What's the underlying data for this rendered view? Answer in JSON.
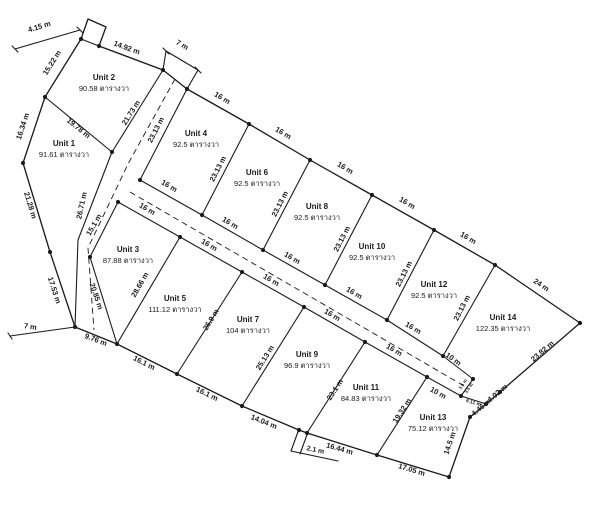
{
  "figure": {
    "kind": "land-subdivision-survey-plan",
    "background": "#ffffff",
    "line_color": "#1a1a1a",
    "text_color": "#1a1a1a",
    "area_unit_label": "ตารางวา"
  },
  "units": [
    {
      "name": "Unit 1",
      "area": "91.61",
      "x": 64,
      "y": 146
    },
    {
      "name": "Unit 2",
      "area": "90.58",
      "x": 104,
      "y": 80
    },
    {
      "name": "Unit 3",
      "area": "87.88",
      "x": 128,
      "y": 252
    },
    {
      "name": "Unit 4",
      "area": "92.5",
      "x": 196,
      "y": 136
    },
    {
      "name": "Unit 5",
      "area": "111.12",
      "x": 175,
      "y": 301
    },
    {
      "name": "Unit 6",
      "area": "92.5",
      "x": 257,
      "y": 175
    },
    {
      "name": "Unit 7",
      "area": "104",
      "x": 248,
      "y": 322
    },
    {
      "name": "Unit 8",
      "area": "92.5",
      "x": 317,
      "y": 209
    },
    {
      "name": "Unit 9",
      "area": "96.9",
      "x": 307,
      "y": 357
    },
    {
      "name": "Unit 10",
      "area": "92.5",
      "x": 372,
      "y": 249
    },
    {
      "name": "Unit 11",
      "area": "84.83",
      "x": 366,
      "y": 390
    },
    {
      "name": "Unit 12",
      "area": "92.5",
      "x": 434,
      "y": 287
    },
    {
      "name": "Unit 13",
      "area": "75.12",
      "x": 433,
      "y": 420
    },
    {
      "name": "Unit 14",
      "area": "122.35",
      "x": 503,
      "y": 320
    }
  ],
  "dimensions": [
    {
      "t": "4.15 m",
      "x": 40,
      "y": 29,
      "r": -17
    },
    {
      "t": "14.92 m",
      "x": 126,
      "y": 50,
      "r": 20
    },
    {
      "t": "7 m",
      "x": 181,
      "y": 47,
      "r": 30
    },
    {
      "t": "15.22 m",
      "x": 54,
      "y": 64,
      "r": -58
    },
    {
      "t": "16.34 m",
      "x": 25,
      "y": 127,
      "r": -72
    },
    {
      "t": "19.78 m",
      "x": 77,
      "y": 130,
      "r": 39
    },
    {
      "t": "21.73 m",
      "x": 133,
      "y": 114,
      "r": -58
    },
    {
      "t": "23.13 m",
      "x": 158,
      "y": 131,
      "r": -63
    },
    {
      "t": "21.28 m",
      "x": 28,
      "y": 206,
      "r": 73
    },
    {
      "t": "26.71 m",
      "x": 84,
      "y": 206,
      "r": -78
    },
    {
      "t": "17.53 m",
      "x": 52,
      "y": 291,
      "r": 72
    },
    {
      "t": "15.1 m",
      "x": 96,
      "y": 226,
      "r": -60
    },
    {
      "t": "20.85 m",
      "x": 94,
      "y": 297,
      "r": 71
    },
    {
      "t": "28.66 m",
      "x": 142,
      "y": 286,
      "r": -60
    },
    {
      "t": "26.9 m",
      "x": 213,
      "y": 321,
      "r": -58
    },
    {
      "t": "25.13 m",
      "x": 267,
      "y": 359,
      "r": -58
    },
    {
      "t": "23.1 m",
      "x": 337,
      "y": 391,
      "r": -57
    },
    {
      "t": "19.32 m",
      "x": 404,
      "y": 412,
      "r": -57
    },
    {
      "t": "9.76 m",
      "x": 95,
      "y": 342,
      "r": 21
    },
    {
      "t": "7 m",
      "x": 30,
      "y": 329,
      "r": 8
    },
    {
      "t": "16.1 m",
      "x": 143,
      "y": 365,
      "r": 27
    },
    {
      "t": "16.1 m",
      "x": 206,
      "y": 396,
      "r": 26
    },
    {
      "t": "14.04 m",
      "x": 263,
      "y": 424,
      "r": 22
    },
    {
      "t": "2.1 m",
      "x": 315,
      "y": 452,
      "r": 12,
      "s": 7
    },
    {
      "t": "16.44 m",
      "x": 339,
      "y": 451,
      "r": 16
    },
    {
      "t": "17.05 m",
      "x": 411,
      "y": 472,
      "r": 17
    },
    {
      "t": "14.5 m",
      "x": 452,
      "y": 444,
      "r": -71
    },
    {
      "t": "4.46 m",
      "x": 483,
      "y": 409,
      "r": -40
    },
    {
      "t": "4.02 m",
      "x": 499,
      "y": 395,
      "r": -40
    },
    {
      "t": "23.82 m",
      "x": 544,
      "y": 353,
      "r": -41
    },
    {
      "t": "24 m",
      "x": 540,
      "y": 287,
      "r": 34
    },
    {
      "t": "16 m",
      "x": 221,
      "y": 100,
      "r": 30
    },
    {
      "t": "16 m",
      "x": 282,
      "y": 135,
      "r": 30
    },
    {
      "t": "16 m",
      "x": 344,
      "y": 170,
      "r": 30
    },
    {
      "t": "16 m",
      "x": 406,
      "y": 205,
      "r": 30
    },
    {
      "t": "16 m",
      "x": 467,
      "y": 240,
      "r": 30
    },
    {
      "t": "16 m",
      "x": 168,
      "y": 188,
      "r": 30
    },
    {
      "t": "16 m",
      "x": 229,
      "y": 225,
      "r": 30
    },
    {
      "t": "16 m",
      "x": 291,
      "y": 260,
      "r": 30
    },
    {
      "t": "16 m",
      "x": 353,
      "y": 295,
      "r": 30
    },
    {
      "t": "16 m",
      "x": 412,
      "y": 330,
      "r": 30
    },
    {
      "t": "16 m",
      "x": 146,
      "y": 211,
      "r": 30
    },
    {
      "t": "16 m",
      "x": 208,
      "y": 247,
      "r": 30
    },
    {
      "t": "16 m",
      "x": 270,
      "y": 282,
      "r": 30
    },
    {
      "t": "16 m",
      "x": 331,
      "y": 317,
      "r": 30
    },
    {
      "t": "16 m",
      "x": 393,
      "y": 352,
      "r": 30
    },
    {
      "t": "23.13 m",
      "x": 220,
      "y": 170,
      "r": -63
    },
    {
      "t": "23.13 m",
      "x": 282,
      "y": 205,
      "r": -63
    },
    {
      "t": "23.13 m",
      "x": 344,
      "y": 240,
      "r": -63
    },
    {
      "t": "23.13 m",
      "x": 406,
      "y": 275,
      "r": -63
    },
    {
      "t": "23.13 m",
      "x": 464,
      "y": 309,
      "r": -63
    },
    {
      "t": "10 m",
      "x": 452,
      "y": 361,
      "r": 35
    },
    {
      "t": "10 m",
      "x": 437,
      "y": 395,
      "r": 29
    },
    {
      "t": "6.11 m",
      "x": 473,
      "y": 404,
      "r": 17,
      "s": 5
    },
    {
      "t": "3.5 m",
      "x": 464,
      "y": 385,
      "r": -55,
      "s": 4.5
    },
    {
      "t": "3.5 m",
      "x": 470,
      "y": 389,
      "r": -55,
      "s": 4.5
    }
  ],
  "geometry": {
    "canvas": {
      "w": 600,
      "h": 506
    },
    "boundary": [
      [
        81,
        39
      ],
      [
        88,
        19
      ],
      [
        106,
        27
      ],
      [
        99,
        46
      ],
      [
        163,
        70
      ],
      [
        187,
        89
      ],
      [
        249,
        124
      ],
      [
        310,
        160
      ],
      [
        372,
        195
      ],
      [
        434,
        230
      ],
      [
        495,
        265
      ],
      [
        580,
        323
      ],
      [
        500,
        392
      ],
      [
        486,
        404
      ],
      [
        470,
        417
      ],
      [
        449,
        477
      ],
      [
        377,
        455
      ],
      [
        307,
        433
      ],
      [
        299,
        430
      ],
      [
        242,
        406
      ],
      [
        177,
        374
      ],
      [
        117,
        344
      ],
      [
        75,
        327
      ],
      [
        50,
        252
      ],
      [
        23,
        163
      ],
      [
        45,
        97
      ]
    ],
    "lines": [
      [
        [
          81,
          39
        ],
        [
          99,
          46
        ]
      ],
      [
        [
          163,
          70
        ],
        [
          112,
          152
        ],
        [
          78,
          240
        ],
        [
          75,
          327
        ]
      ],
      [
        [
          187,
          89
        ],
        [
          140,
          180
        ]
      ],
      [
        [
          118,
          202
        ],
        [
          90,
          257
        ],
        [
          117,
          344
        ]
      ],
      [
        [
          140,
          180
        ],
        [
          202,
          215
        ],
        [
          263,
          250
        ],
        [
          325,
          285
        ],
        [
          387,
          320
        ],
        [
          443,
          356
        ],
        [
          473,
          379
        ]
      ],
      [
        [
          118,
          202
        ],
        [
          180,
          237
        ],
        [
          242,
          272
        ],
        [
          304,
          307
        ],
        [
          365,
          342
        ],
        [
          427,
          377
        ],
        [
          461,
          396
        ]
      ],
      [
        [
          473,
          379
        ],
        [
          461,
          396
        ]
      ],
      [
        [
          461,
          396
        ],
        [
          486,
          404
        ]
      ],
      [
        [
          45,
          97
        ],
        [
          112,
          152
        ]
      ],
      [
        [
          180,
          237
        ],
        [
          117,
          344
        ]
      ],
      [
        [
          242,
          272
        ],
        [
          177,
          374
        ]
      ],
      [
        [
          304,
          307
        ],
        [
          242,
          406
        ]
      ],
      [
        [
          365,
          342
        ],
        [
          307,
          433
        ]
      ],
      [
        [
          427,
          377
        ],
        [
          377,
          455
        ]
      ],
      [
        [
          249,
          124
        ],
        [
          202,
          215
        ]
      ],
      [
        [
          310,
          160
        ],
        [
          263,
          250
        ]
      ],
      [
        [
          372,
          195
        ],
        [
          325,
          285
        ]
      ],
      [
        [
          434,
          230
        ],
        [
          387,
          320
        ]
      ],
      [
        [
          495,
          265
        ],
        [
          443,
          356
        ]
      ],
      [
        [
          15,
          49
        ],
        [
          80,
          30
        ]
      ],
      [
        [
          12,
          46
        ],
        [
          18,
          52
        ]
      ],
      [
        [
          77,
          27
        ],
        [
          83,
          33
        ]
      ],
      [
        [
          163,
          70
        ],
        [
          166,
          51
        ]
      ],
      [
        [
          187,
          89
        ],
        [
          198,
          70
        ]
      ],
      [
        [
          166,
          51
        ],
        [
          198,
          70
        ]
      ],
      [
        [
          163,
          48
        ],
        [
          169,
          54
        ]
      ],
      [
        [
          195,
          67
        ],
        [
          201,
          73
        ]
      ],
      [
        [
          75,
          327
        ],
        [
          10,
          336
        ]
      ],
      [
        [
          8,
          333
        ],
        [
          12,
          339
        ]
      ],
      [
        [
          299,
          429
        ],
        [
          291,
          451
        ]
      ],
      [
        [
          308,
          432
        ],
        [
          300,
          454
        ]
      ],
      [
        [
          291,
          451
        ],
        [
          338,
          461
        ]
      ]
    ],
    "dashed": [
      [
        [
          175,
          79
        ],
        [
          128,
          164
        ],
        [
          88,
          248
        ],
        [
          94,
          330
        ]
      ],
      [
        [
          130,
          192
        ],
        [
          466,
          387
        ]
      ]
    ],
    "dots": [
      [
        45,
        97
      ],
      [
        112,
        152
      ],
      [
        23,
        163
      ],
      [
        50,
        252
      ],
      [
        90,
        257
      ],
      [
        75,
        327
      ],
      [
        117,
        344
      ],
      [
        177,
        374
      ],
      [
        242,
        406
      ],
      [
        299,
        430
      ],
      [
        307,
        433
      ],
      [
        377,
        455
      ],
      [
        449,
        477
      ],
      [
        470,
        417
      ],
      [
        486,
        404
      ],
      [
        500,
        392
      ],
      [
        580,
        323
      ],
      [
        495,
        265
      ],
      [
        434,
        230
      ],
      [
        372,
        195
      ],
      [
        310,
        160
      ],
      [
        249,
        124
      ],
      [
        187,
        89
      ],
      [
        163,
        70
      ],
      [
        140,
        180
      ],
      [
        118,
        202
      ],
      [
        202,
        215
      ],
      [
        263,
        250
      ],
      [
        325,
        285
      ],
      [
        387,
        320
      ],
      [
        443,
        356
      ],
      [
        473,
        379
      ],
      [
        461,
        396
      ],
      [
        427,
        377
      ],
      [
        365,
        342
      ],
      [
        304,
        307
      ],
      [
        242,
        272
      ],
      [
        180,
        237
      ],
      [
        99,
        46
      ],
      [
        81,
        39
      ]
    ]
  }
}
